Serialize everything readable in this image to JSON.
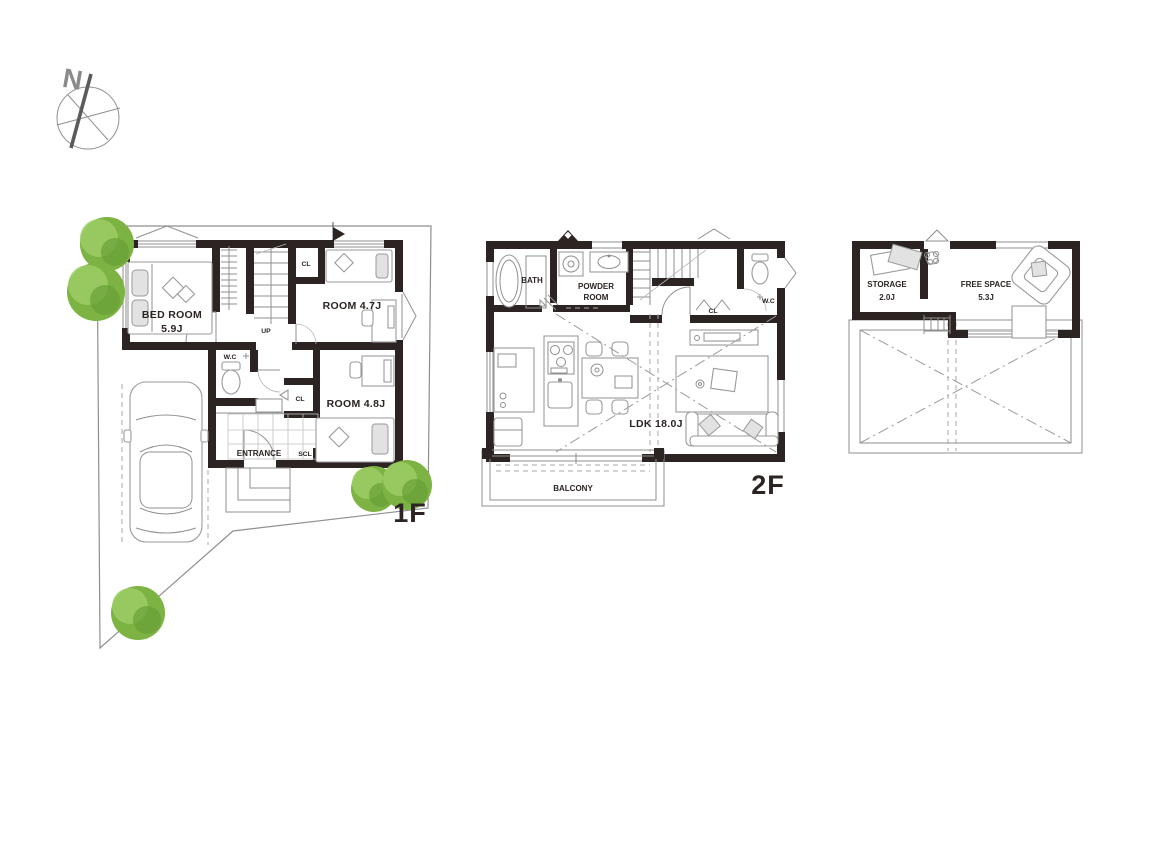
{
  "compass": {
    "north": "N"
  },
  "floor_1f": {
    "label": "1F",
    "bedroom": {
      "name": "BED ROOM",
      "size": "5.9J"
    },
    "room_a": {
      "name": "ROOM 4.7J"
    },
    "room_b": {
      "name": "ROOM 4.8J"
    },
    "wc": "W.C",
    "closet_a": "CL",
    "closet_b": "CL",
    "stairs": "UP",
    "entrance": "ENTRANCE",
    "shoe_closet": "SCL"
  },
  "floor_2f": {
    "label": "2F",
    "bath": "BATH",
    "powder_room": {
      "line1": "POWDER",
      "line2": "ROOM"
    },
    "wc": "W.C",
    "closet": "CL",
    "ldk": "LDK 18.0J",
    "balcony": "BALCONY"
  },
  "floor_3f": {
    "storage": {
      "name": "STORAGE",
      "size": "2.0J"
    },
    "free_space": {
      "name": "FREE SPACE",
      "size": "5.3J"
    }
  },
  "colors": {
    "wall": "#2b2422",
    "ink": "#2b2422",
    "line": "#8f8f8f",
    "tree_dark": "#689f38",
    "tree_mid": "#7cb342",
    "tree_light": "#9ccc65"
  }
}
